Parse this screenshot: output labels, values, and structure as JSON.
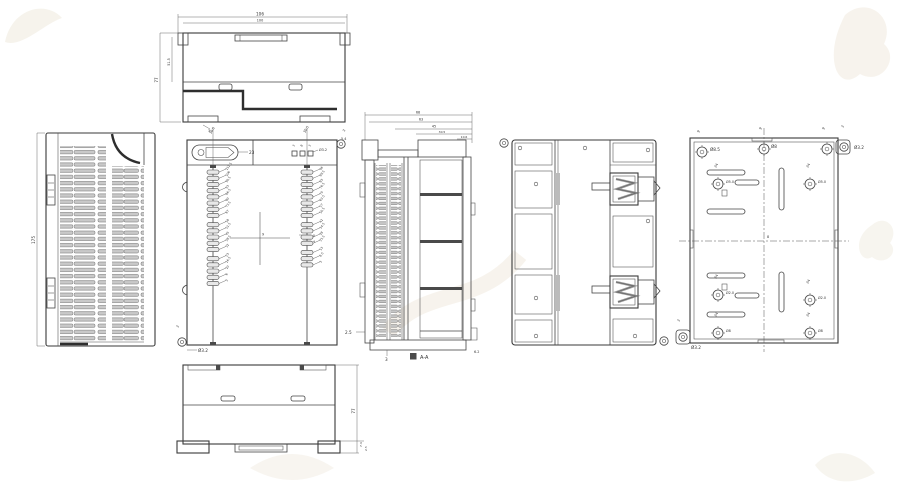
{
  "drawing_title": "Enclosure multi-view engineering drawing",
  "colors": {
    "line": "#3a3a3a",
    "slat_fill": "#c9c9c9",
    "watermark": "#efe9dd"
  },
  "views": {
    "top": {
      "dim_w1": "106",
      "dim_w2": "100",
      "dim_h": "77",
      "dim_h2": "51.5",
      "dim_foot": "3"
    },
    "side": {
      "dim_h": "175"
    },
    "front": {
      "dim_left": "36.5",
      "dim_right": "30.5",
      "dim_corner": "3",
      "dim_oval": "23",
      "hole_labels": [
        "3",
        "8",
        "3"
      ],
      "hole_dia": "Ø3.2",
      "ear_dia": "Ø3.2",
      "ear_off": "3",
      "dim_c1": "9",
      "dim_c2": "8",
      "dim_c3": "4",
      "left_terminals": [
        "112.5",
        "106",
        "99.5",
        "93",
        "86.5",
        "80",
        "73.5",
        "67",
        "58",
        "51.5",
        "45",
        "38.5",
        "32",
        "23",
        "16.5",
        "10",
        "6",
        "3"
      ],
      "right_terminals": [
        "96",
        "89.5",
        "83",
        "76.5",
        "70",
        "63.5",
        "57",
        "50.5",
        "41",
        "34.5",
        "28",
        "21.5",
        "13",
        "6.5",
        "3"
      ]
    },
    "section": {
      "dims": [
        "68",
        "63",
        "45",
        "30.5",
        "10.6"
      ],
      "dim_left": "5.4",
      "dim_wall": "2.5",
      "dim_base": "3",
      "dim_step": "6.2",
      "caption": "A-A"
    },
    "back": {},
    "base": {
      "ear_dia_tr": "Ø3.2",
      "ear_dia_bl": "Ø3.2",
      "boss_tl": "Ø8.5",
      "boss_tc": "Ø8",
      "boss_ml": "Ø5.0",
      "boss_mr": "Ø5.0",
      "boss_ml2": "Ø2.0",
      "boss_mr2": "Ø2.0",
      "boss_bl": "Ø8",
      "boss_br": "Ø8",
      "off9": "9",
      "off3": "3",
      "pitch24": "24",
      "center": "8"
    },
    "bottom": {
      "dim_h": "77",
      "dim_f1": "7.4",
      "dim_f2": "2.5"
    }
  }
}
